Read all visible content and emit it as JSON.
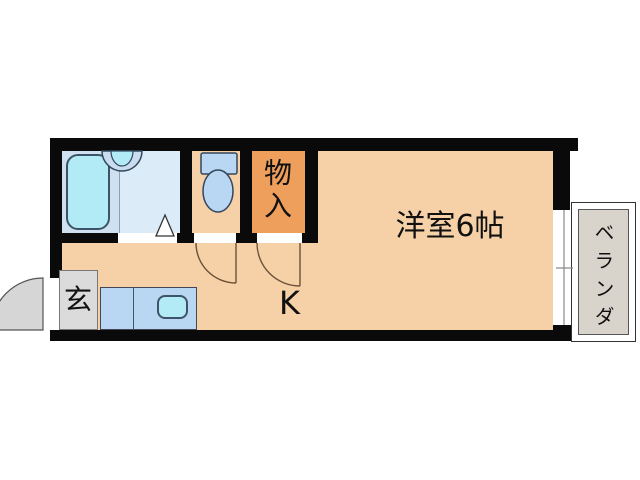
{
  "labels": {
    "storage": "物入",
    "main_room": "洋室6帖",
    "kitchen": "K",
    "entrance": "玄",
    "veranda": "ベランダ"
  },
  "colors": {
    "wall": "#0a0a0a",
    "floor": "#f6d1a7",
    "storage": "#ef9f5c",
    "bathroom_dark": "#cfe0f1",
    "bathroom_light": "#dcebf8",
    "cyan": "#b2ebf5",
    "fixture_blue": "#b9d6f2",
    "genkan_grey": "#dbdbdb",
    "door_grey": "#d6d6d6",
    "veranda_grey": "#d8d3cb",
    "arc": "#6b5138"
  }
}
